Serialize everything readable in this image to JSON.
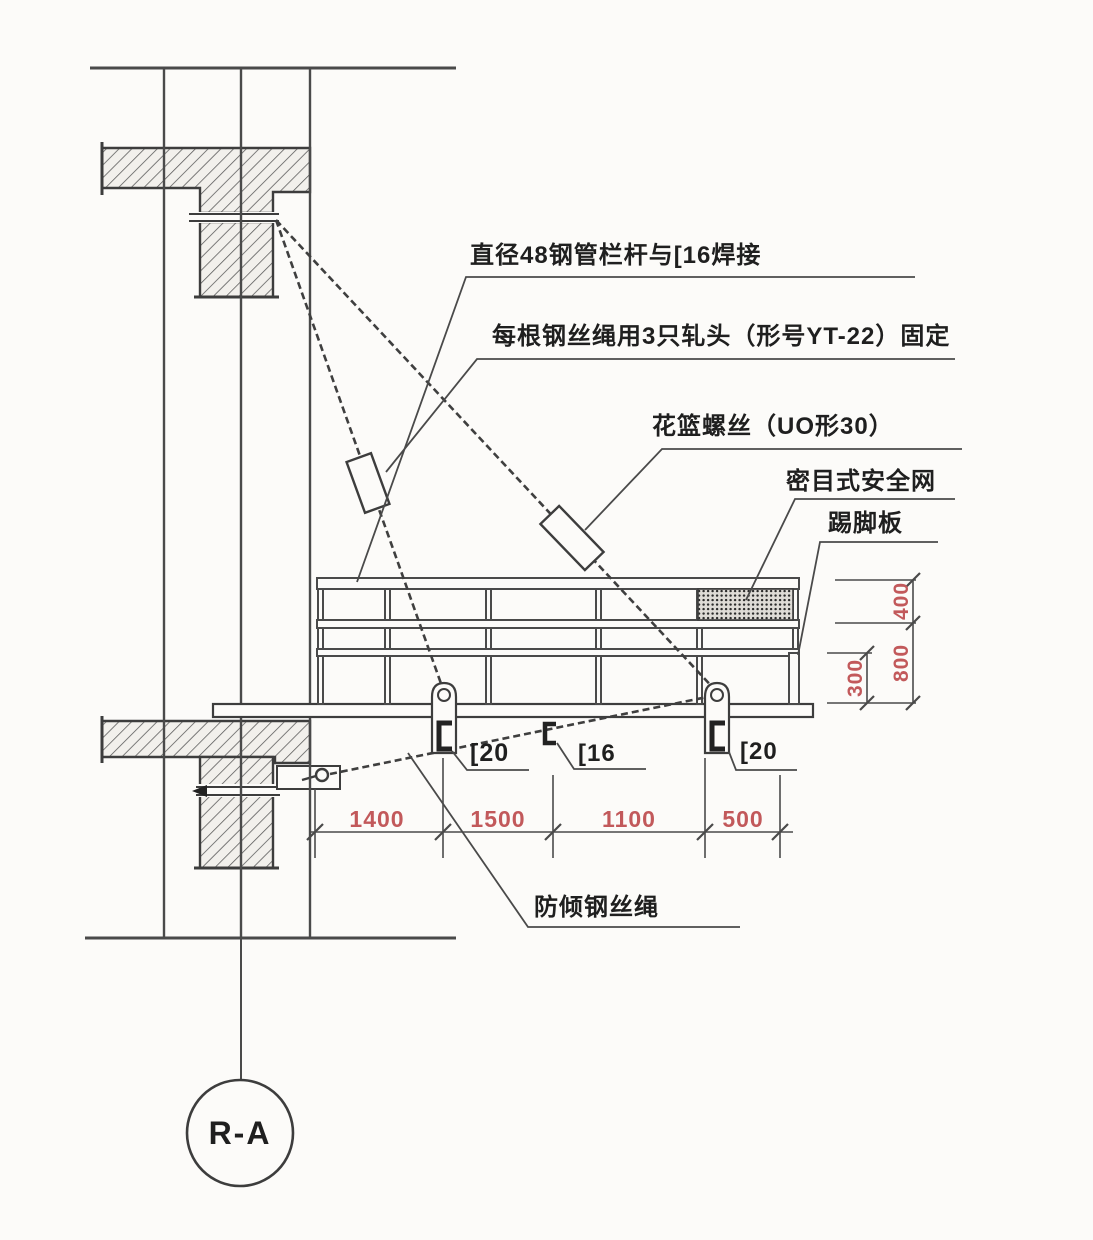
{
  "drawing": {
    "annotations": {
      "rail_weld": {
        "text": "直径48钢管栏杆与[16焊接"
      },
      "rope_clips": {
        "text": "每根钢丝绳用3只轧头（形号YT-22）固定"
      },
      "turnbuckle": {
        "text": "花篮螺丝（UO形30）"
      },
      "safety_net": {
        "text": "密目式安全网"
      },
      "toe_board": {
        "text": "踢脚板"
      },
      "anti_tip_rope": {
        "text": "防倾钢丝绳"
      },
      "channel_left": {
        "text": "[20"
      },
      "channel_mid": {
        "text": "[16"
      },
      "channel_right": {
        "text": "[20"
      }
    },
    "dimensions": {
      "bottom": [
        "1400",
        "1500",
        "1100",
        "500"
      ],
      "right": [
        "400",
        "800",
        "300"
      ]
    },
    "grid_bubble": {
      "text": "R-A"
    },
    "colors": {
      "dimension": "#c2595b",
      "line": "#3d3d3d",
      "text": "#1f1f1f"
    }
  }
}
